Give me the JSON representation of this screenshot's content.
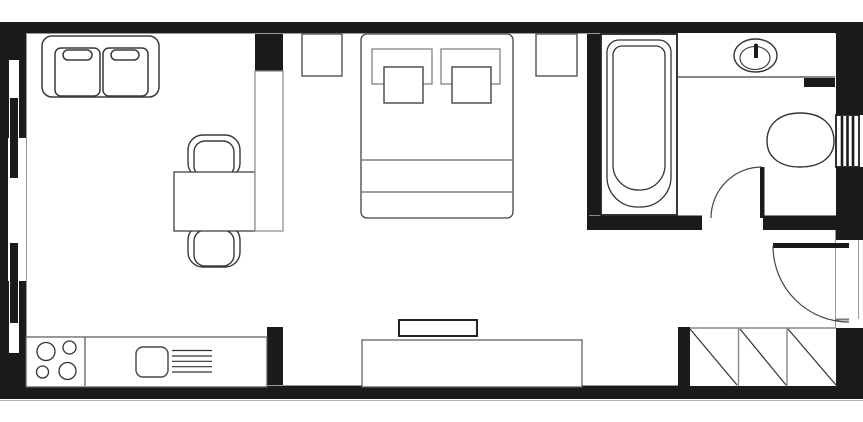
{
  "diagram": {
    "kind": "floor-plan",
    "subject": "studio-apartment",
    "palette": {
      "wall": "#1b1b1b",
      "outline_dark": "#333333",
      "outline_mid": "#555555",
      "outline_light": "#999999",
      "floor": "#ffffff"
    },
    "rooms": [
      {
        "name": "living-area",
        "furniture": [
          "sofa",
          "dining-table",
          "chair-top",
          "chair-bottom",
          "room-divider",
          "tv",
          "tv-console"
        ]
      },
      {
        "name": "kitchen",
        "furniture": [
          "kitchen-counter",
          "hob-four-burners",
          "kitchen-sink",
          "drainer"
        ]
      },
      {
        "name": "bedroom",
        "furniture": [
          "double-bed",
          "pillow-left",
          "pillow-right",
          "duvet-left",
          "duvet-right",
          "nightstand-left",
          "nightstand-right"
        ]
      },
      {
        "name": "bathroom",
        "furniture": [
          "bathtub",
          "basin-counter",
          "washbasin",
          "tap",
          "toilet",
          "cistern"
        ]
      },
      {
        "name": "hallway",
        "furniture": [
          "closet-three-sections"
        ]
      }
    ],
    "openings": {
      "windows": [
        "left-wall-window-upper-sash",
        "left-wall-window-lower-sash"
      ],
      "doors": [
        "bathroom-door",
        "entry-door"
      ]
    },
    "closet_sections": 3,
    "hob_burners": 4
  }
}
